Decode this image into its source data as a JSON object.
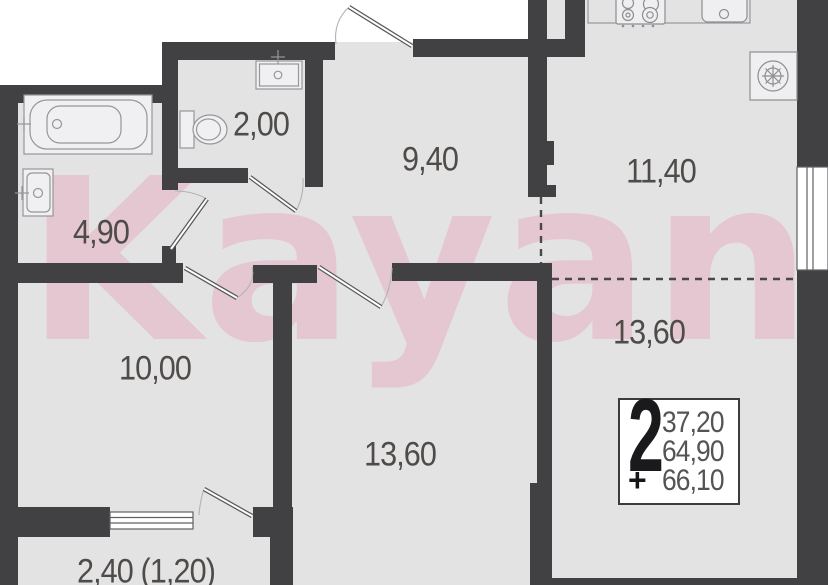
{
  "watermark": {
    "text": "Kayan"
  },
  "rooms": {
    "wc": {
      "label": "2,00"
    },
    "hallway": {
      "label": "9,40"
    },
    "kitchen": {
      "label": "11,40"
    },
    "bathroom": {
      "label": "4,90"
    },
    "living": {
      "label": "13,60"
    },
    "bedroom": {
      "label": "10,00"
    },
    "room2": {
      "label": "13,60"
    },
    "balcony": {
      "label": "2,40 (1,20)"
    }
  },
  "info": {
    "room_count": "2",
    "area_living": "37,20",
    "area_main": "64,90",
    "plus": "+",
    "area_total": "66,10"
  },
  "colors": {
    "wall": "#414043",
    "room_fill": "#e4e3e4",
    "watermark_pink": "#e4b0c0",
    "label_text": "#4e4b49"
  }
}
